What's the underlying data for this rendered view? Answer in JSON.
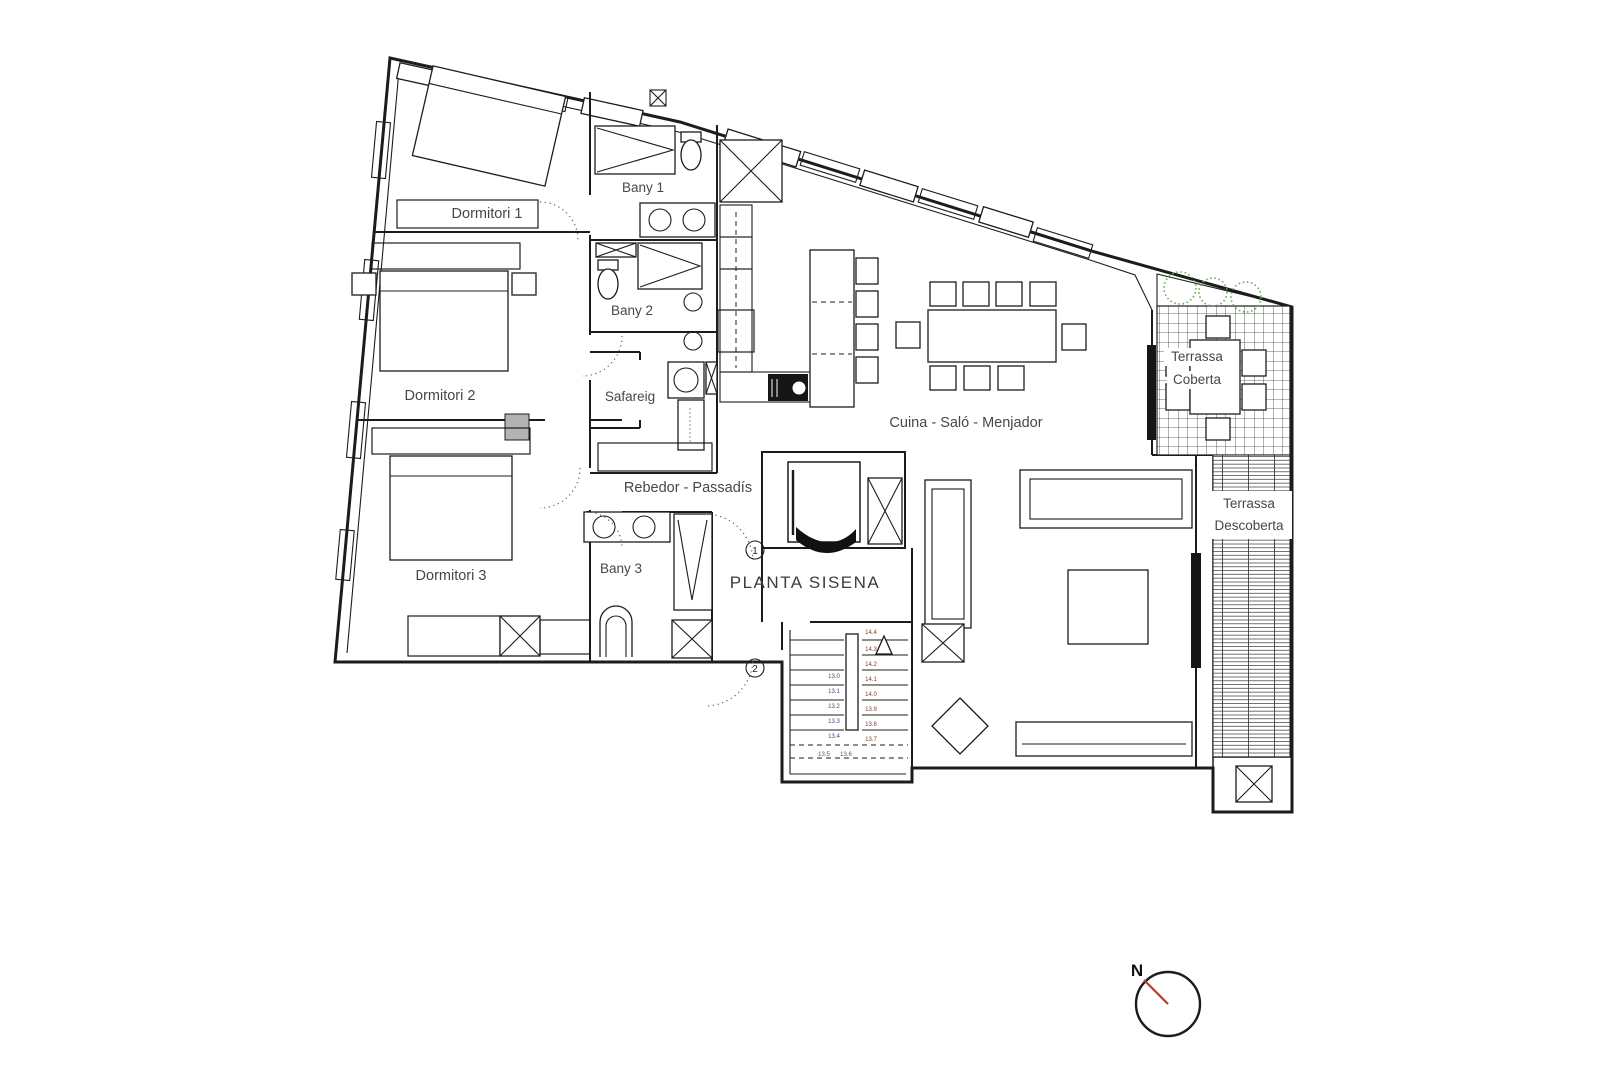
{
  "floor_plan": {
    "title": "PLANTA SISENA",
    "rooms": {
      "dormitori1": "Dormitori 1",
      "dormitori2": "Dormitori 2",
      "dormitori3": "Dormitori 3",
      "bany1": "Bany 1",
      "bany2": "Bany 2",
      "bany3": "Bany 3",
      "safareig": "Safareig",
      "rebedor_passadis": "Rebedor - Passadís",
      "cuina_salo_menjador": "Cuina - Saló - Menjador",
      "terrassa_coberta": {
        "line1": "Terrassa",
        "line2": "Coberta"
      },
      "terrassa_descoberta": {
        "line1": "Terrassa",
        "line2": "Descoberta"
      }
    },
    "entrances": {
      "door1": "1",
      "door2": "2"
    },
    "compass": {
      "north_label": "N",
      "needle_color": "#c0392b"
    },
    "stairs": {
      "right_levels": [
        "14.4",
        "14.3",
        "14.2",
        "14.1",
        "14.0",
        "13.9",
        "13.8",
        "13.7"
      ],
      "left_levels": [
        "13.0",
        "13.1",
        "13.2",
        "13.3",
        "13.4"
      ],
      "bottom_levels": [
        "13.5",
        "13.6"
      ]
    },
    "colors": {
      "wall": "#1c1c1c",
      "label": "#44474b",
      "terrace_green": "#67b34c"
    }
  }
}
